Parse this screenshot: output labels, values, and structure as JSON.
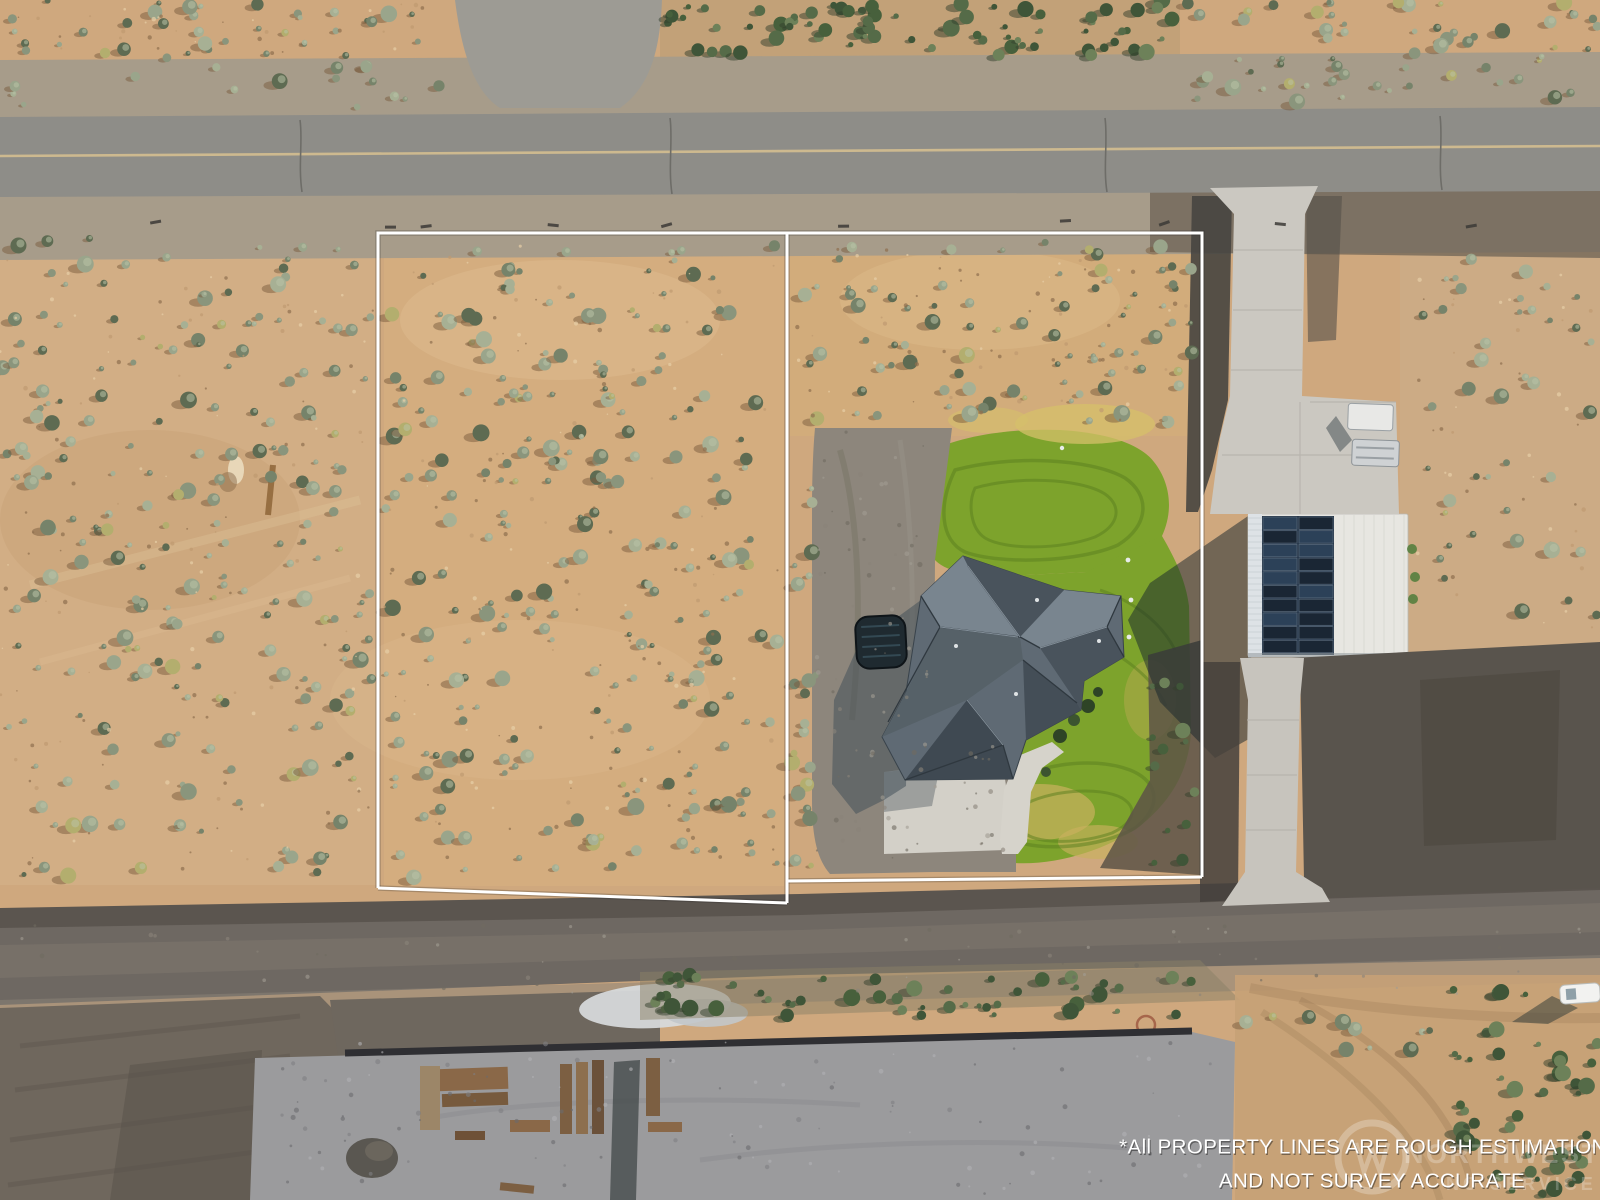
{
  "photo": {
    "description": "Aerial drone photo of a rural desert property with a house, detached solar shop, and white estimated property-line overlay"
  },
  "disclaimer": {
    "line1": "*All PROPERTY LINES ARE ROUGH ESTIMATIONS",
    "line2": "AND NOT SURVEY ACCURATE"
  },
  "watermark": {
    "logo": "nwmls-circle-logo",
    "text_primary": "NORTHWEST",
    "text_secondary": "NO SERVICE"
  },
  "overlay": {
    "property_line_color": "#ffffff"
  },
  "colors": {
    "desert": "#cfa87e",
    "desertLight": "#dcbb92",
    "desertDark": "#b8946c",
    "asphaltTop": "#8e8d88",
    "centerline": "#cdb98f",
    "asphaltBottom": "#6e6862",
    "gravelPad": "#9d9b94",
    "lawn": "#7da32c",
    "lawnStripe": "#5a7f1f",
    "dryLawn": "#c9b05e",
    "roof": "#5f6a74",
    "roofLight": "#79858f",
    "roofDark": "#49535c",
    "roofDarkest": "#3f4952",
    "concrete": "#cbc8c1",
    "shopRoof": "#e7e6e1",
    "solar": "#1a2634",
    "constructionPad": "#9b9b9d",
    "bushSage": [
      "#8a957c",
      "#9aa58b",
      "#76836a",
      "#a7b094",
      "#5e6b52"
    ],
    "bushGreen": [
      "#556b48",
      "#3f5538",
      "#6d8159",
      "#47603c"
    ],
    "bushYellow": "#b3ae6e",
    "bushShadowTan": "#7a5c3e",
    "bushShadowGreen": "#33402c",
    "speckle": [
      "#e7cfa6",
      "#bf9a70",
      "#8f6f4e"
    ],
    "gravelSpeckle": [
      "#6f6a60",
      "#a19c92",
      "#8a8479"
    ],
    "padSpeckle": [
      "#7e7e82",
      "#6a6a6e",
      "#b0b0b4"
    ]
  }
}
